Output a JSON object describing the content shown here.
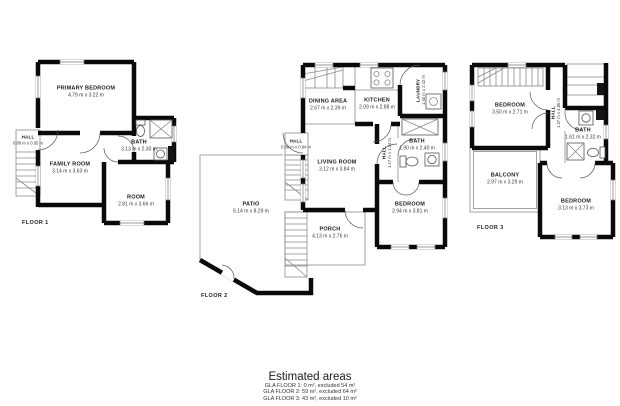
{
  "floors": [
    {
      "label": "FLOOR 1",
      "rooms": [
        {
          "name": "PRIMARY BEDROOM",
          "dims": "4.79 m x 3.22 m"
        },
        {
          "name": "HALL",
          "dims": "0.88 m x 0.95 m"
        },
        {
          "name": "FAMILY ROOM",
          "dims": "3.14 m x 3.63 m"
        },
        {
          "name": "BATH",
          "dims": "3.13 m x 2.30 m"
        },
        {
          "name": "ROOM",
          "dims": "2.81 m x 3.66 m"
        }
      ]
    },
    {
      "label": "FLOOR 2",
      "rooms": [
        {
          "name": "DINING AREA",
          "dims": "2.67 m x 2.39 m"
        },
        {
          "name": "KITCHEN",
          "dims": "2.09 m x 2.88 m"
        },
        {
          "name": "LAUNDRY",
          "dims": "1.40 m x 2.42 m"
        },
        {
          "name": "HALL",
          "dims": "0.88 m x 0.94 m"
        },
        {
          "name": "LIVING ROOM",
          "dims": "3.12 m x 3.84 m"
        },
        {
          "name": "HALL",
          "dims": "1.17 m x 1.04 m"
        },
        {
          "name": "BATH",
          "dims": "1.90 m x 2.40 m"
        },
        {
          "name": "BEDROOM",
          "dims": "2.94 m x 3.81 m"
        },
        {
          "name": "PATIO",
          "dims": "5.14 m x 8.29 m"
        },
        {
          "name": "PORCH",
          "dims": "4.13 m x 2.76 m"
        }
      ]
    },
    {
      "label": "FLOOR 3",
      "rooms": [
        {
          "name": "BEDROOM",
          "dims": "3.50 m x 2.71 m"
        },
        {
          "name": "HALL",
          "dims": "1.37 m x 4.86 m"
        },
        {
          "name": "BATH",
          "dims": "1.61 m x 2.32 m"
        },
        {
          "name": "BALCONY",
          "dims": "2.97 m x 3.29 m"
        },
        {
          "name": "BEDROOM",
          "dims": "3.13 m x 3.73 m"
        }
      ]
    }
  ],
  "legend": {
    "title": "Estimated areas",
    "lines": [
      "GLA FLOOR 1: 0 m², excluded 54 m²",
      "GLA FLOOR 2: 59 m², excluded 64 m²",
      "GLA FLOOR 3: 43 m², excluded 10 m²"
    ]
  }
}
